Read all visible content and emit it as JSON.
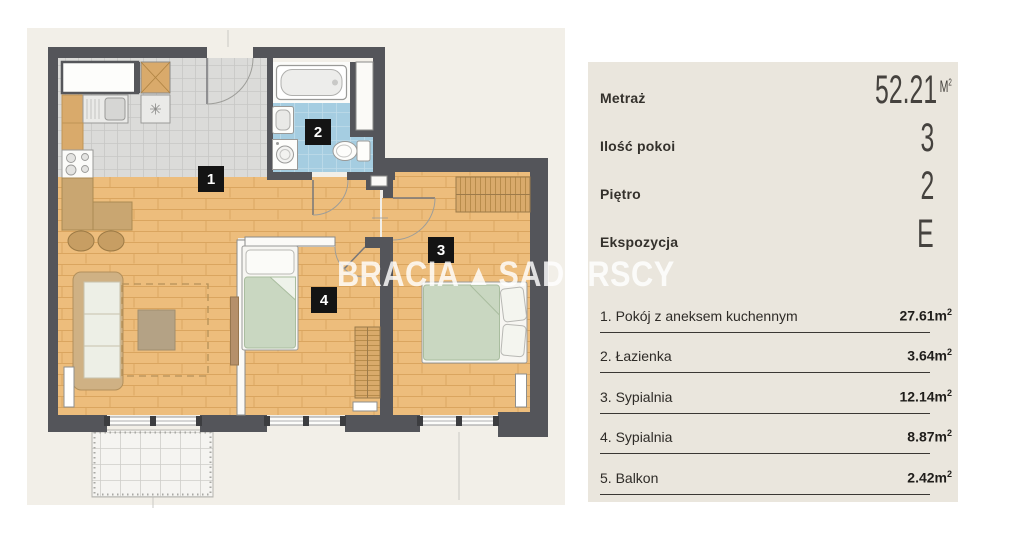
{
  "watermark": {
    "word1": "BRACIA",
    "word2": "SADURSCY",
    "logo_glyph": "▲",
    "logo_icon": "brand-triangle-logo"
  },
  "plan": {
    "markers": {
      "m1": "1",
      "m2": "2",
      "m3": "3",
      "m4": "4"
    },
    "marker_meaning": {
      "m1": "living-room-with-kitchenette",
      "m2": "bathroom",
      "m3": "bedroom",
      "m4": "bedroom"
    }
  },
  "panel": {
    "specs": [
      {
        "label": "Metraż",
        "value": "52.21",
        "unit": "M",
        "unit_sup": "2"
      },
      {
        "label": "Ilość pokoi",
        "value": "3"
      },
      {
        "label": "Piętro",
        "value": "2"
      },
      {
        "label": "Ekspozycja",
        "value": "E"
      }
    ],
    "rooms": [
      {
        "label": "1. Pokój z aneksem kuchennym",
        "area": "27.61",
        "unit": "m",
        "unit_sup": "2"
      },
      {
        "label": "2. Łazienka",
        "area": "3.64",
        "unit": "m",
        "unit_sup": "2"
      },
      {
        "label": "3. Sypialnia",
        "area": "12.14",
        "unit": "m",
        "unit_sup": "2"
      },
      {
        "label": "4. Sypialnia",
        "area": "8.87",
        "unit": "m",
        "unit_sup": "2"
      },
      {
        "label": "5. Balkon",
        "area": "2.42",
        "unit": "m",
        "unit_sup": "2"
      }
    ]
  },
  "colors": {
    "wall": "#54555a",
    "wood_floor": "#edbd7c",
    "kitchen_tile": "#dbdbd9",
    "bathroom_tile": "#a5cde1",
    "furniture_tan": "#d9aa6b",
    "bed_green": "#c9d7c1",
    "panel_bg": "#eae6dd",
    "plan_bg": "#f2efe8",
    "marker_bg": "#141414"
  }
}
